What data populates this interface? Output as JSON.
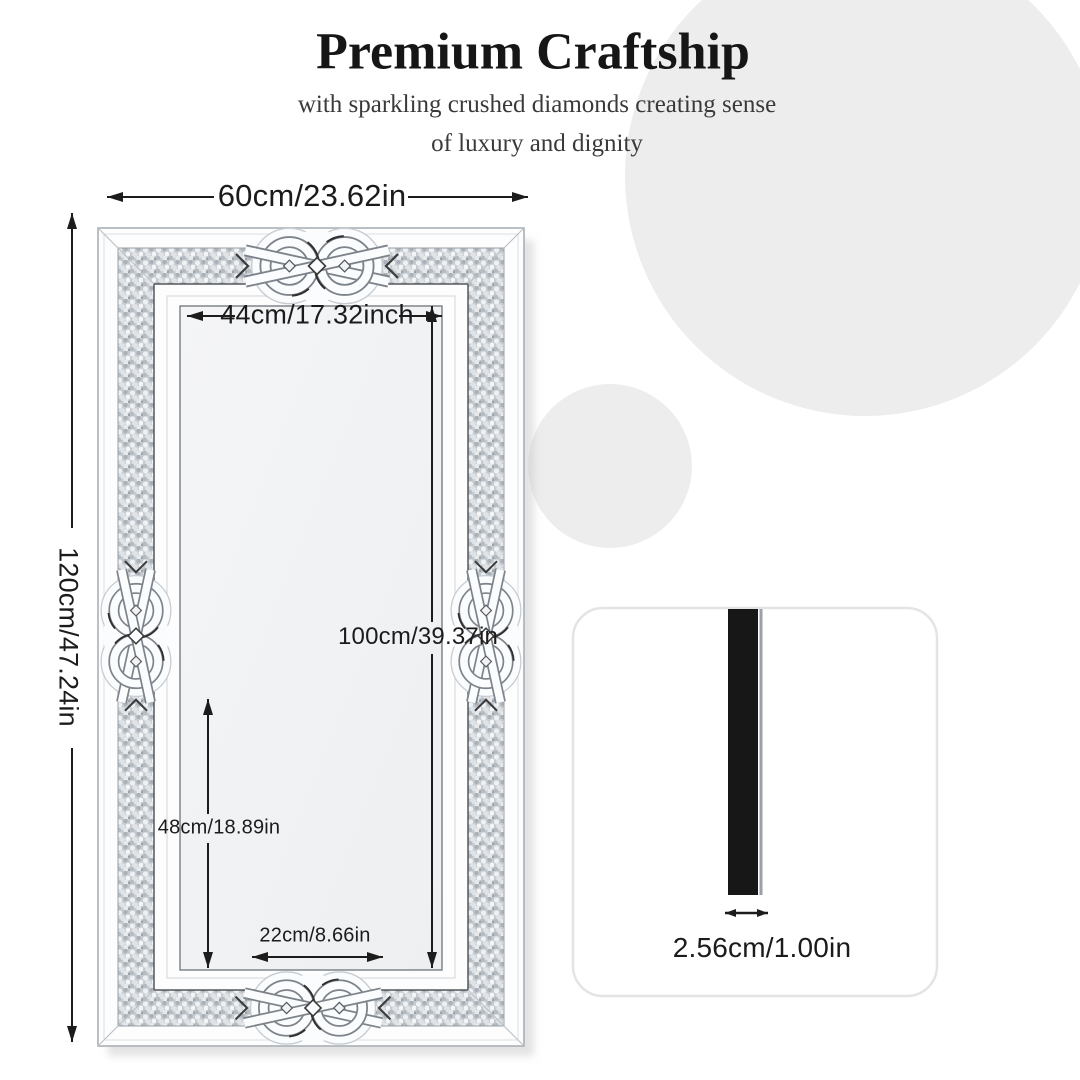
{
  "header": {
    "title": "Premium Craftship",
    "subtitle_line1": "with sparkling crushed diamonds creating sense",
    "subtitle_line2": "of luxury and dignity"
  },
  "dimensions": {
    "outer_width": "60cm/23.62in",
    "outer_height": "120cm/47.24in",
    "inner_width": "44cm/17.32inch",
    "inner_height": "100cm/39.37in",
    "lower_section_height": "48cm/18.89in",
    "bottom_center_width": "22cm/8.66in",
    "thickness": "2.56cm/1.00in"
  },
  "colors": {
    "background": "#ffffff",
    "accent_circle": "#ededee",
    "text": "#1b1b1b",
    "dimension_lines": "#1c1c1c",
    "diamond_band": "#c6cbd0",
    "mirror_surface": "#f1f3f4",
    "card_border": "#e4e4e4",
    "side_bar": "#171717"
  },
  "icons": {
    "dimension_arrows": "double-headed-arrow",
    "ornament": "celtic-knot"
  }
}
